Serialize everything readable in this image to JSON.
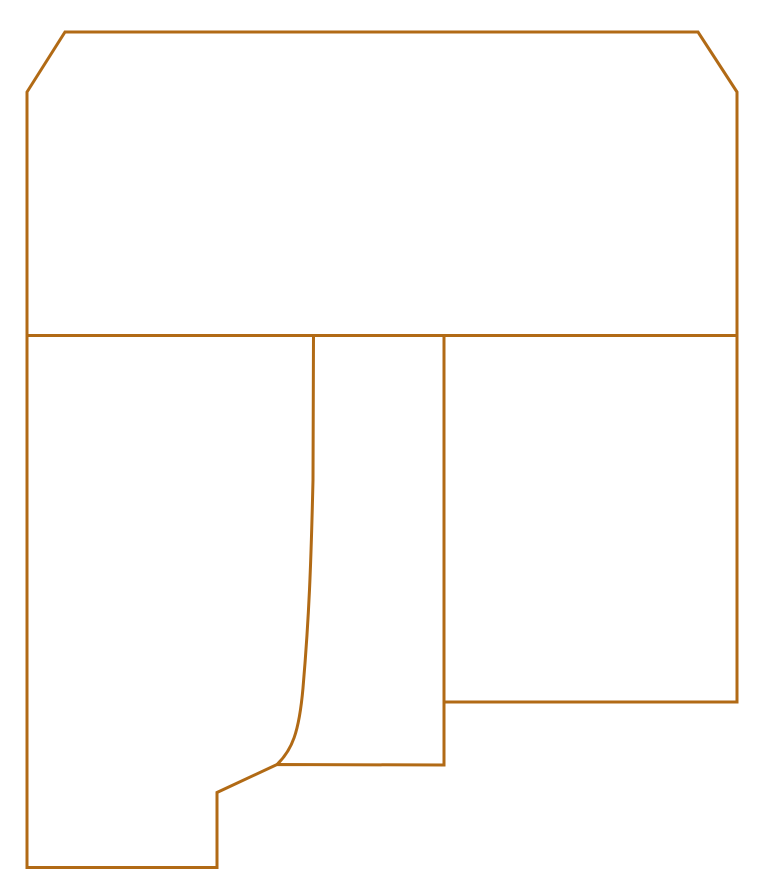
{
  "canvas": {
    "width": 777,
    "height": 896,
    "background_color": "#ffffff"
  },
  "drawing": {
    "description": "technical outline profile drawing",
    "stroke_color": "#b16a15",
    "stroke_width": 3,
    "viewbox": "0 0 777 896",
    "shapes": {
      "outer_boundary": {
        "id": "outer-boundary",
        "type": "closed-path",
        "d": "M 65,32 L 698,32 L 737,92 L 737,702 L 444,702 L 444,765 L 277,764.5 L 217,792.5 L 217,867.5 L 27,867.5 L 27,92 Z"
      },
      "horizontal_divider": {
        "id": "horizontal-divider",
        "type": "line",
        "d": "M 27,335.5 L 737,335.5"
      },
      "vertical_divider": {
        "id": "vertical-divider",
        "type": "line",
        "d": "M 444,335.5 L 444,702"
      },
      "curved_profile_line": {
        "id": "curved-profile-line",
        "type": "curve",
        "d": "M 313.5,336 L 313,480 C 311,565 309,618 303,688 C 299,733 292,750 277,764.5"
      }
    }
  }
}
